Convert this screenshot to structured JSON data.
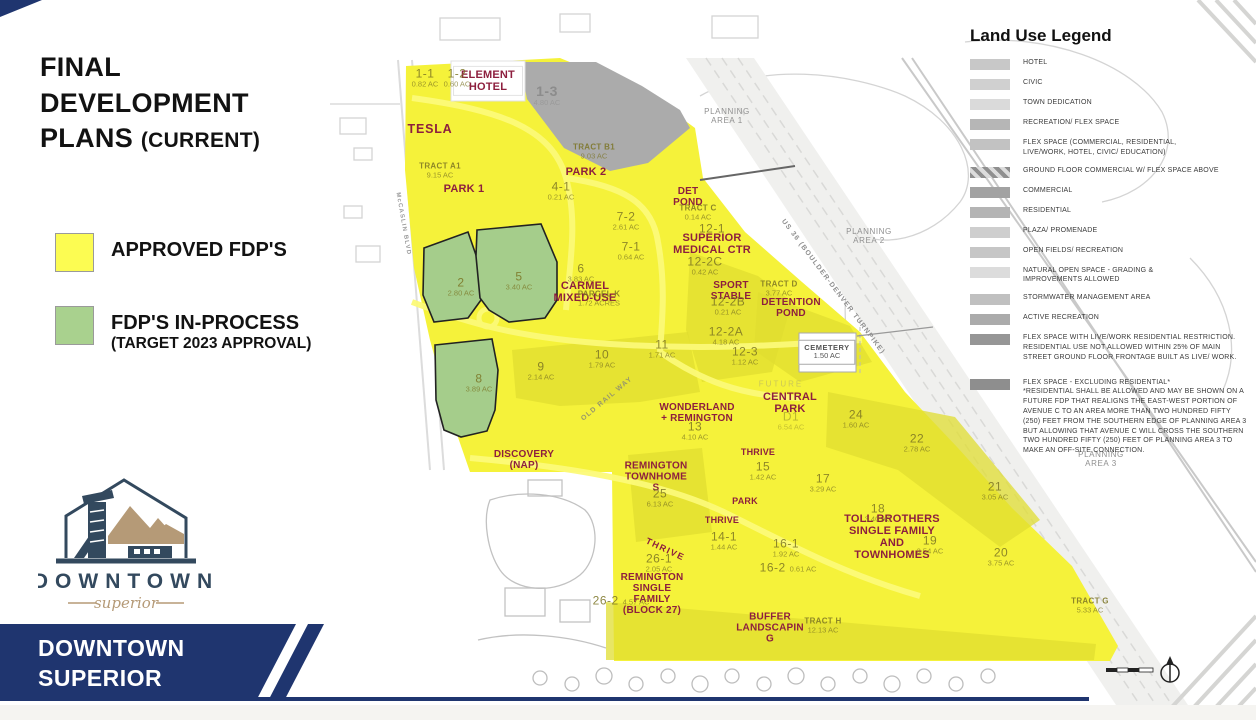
{
  "slide": {
    "title_line1": "FINAL",
    "title_line2": "DEVELOPMENT",
    "title_line3": "PLANS",
    "title_line3_suffix": "(CURRENT)",
    "fdp_legend": [
      {
        "label": "APPROVED FDP'S",
        "color": "#fcfc52"
      },
      {
        "label": "FDP'S IN-PROCESS",
        "sublabel": "(TARGET 2023 APPROVAL)",
        "color": "#a9d18e"
      }
    ],
    "logo": {
      "wordmark": "DOWNTOWN",
      "script": "superior"
    },
    "banner": {
      "line1": "DOWNTOWN",
      "line2": "SUPERIOR"
    },
    "colors": {
      "banner_navy": "#1f356f",
      "approved_yellow": "#f5f23a",
      "inprocess_green": "#a5cd8b",
      "label_red": "#8d1f3e"
    }
  },
  "land_use_legend": {
    "title": "Land Use Legend",
    "items": [
      {
        "label": "HOTEL",
        "color": "#c8c8c8"
      },
      {
        "label": "CIVIC",
        "color": "#d0d0d0"
      },
      {
        "label": "TOWN DEDICATION",
        "color": "#dadada"
      },
      {
        "label": "RECREATION/ FLEX SPACE",
        "color": "#b6b6b6"
      },
      {
        "label": "FLEX SPACE (COMMERCIAL, RESIDENTIAL,\nLIVE/WORK, HOTEL, CIVIC/ EDUCATION)",
        "color": "#c2c2c2"
      },
      {
        "label": "GROUND FLOOR COMMERCIAL W/ FLEX SPACE ABOVE",
        "color": "#c9c9c9"
      },
      {
        "label": "COMMERCIAL",
        "color": "#a2a2a2"
      },
      {
        "label": "RESIDENTIAL",
        "color": "#b4b4b4"
      },
      {
        "label": "PLAZA/ PROMENADE",
        "color": "#cecece"
      },
      {
        "label": "OPEN FIELDS/ RECREATION",
        "color": "#c6c6c6"
      },
      {
        "label": "NATURAL OPEN SPACE - GRADING &\nIMPROVEMENTS ALLOWED",
        "color": "#dcdcdc"
      },
      {
        "label": "STORMWATER MANAGEMENT AREA",
        "color": "#c0c0c0"
      },
      {
        "label": "ACTIVE RECREATION",
        "color": "#ababab"
      },
      {
        "label": "FLEX SPACE WITH LIVE/WORK RESIDENTIAL RESTRICTION. RESIDENTIAL USE NOT ALLOWED WITHIN 25% OF MAIN STREET GROUND FLOOR FRONTAGE BUILT AS LIVE/ WORK.",
        "color": "#969696"
      },
      {
        "label": "FLEX SPACE - EXCLUDING RESIDENTIAL*\n*RESIDENTIAL SHALL BE ALLOWED AND MAY BE SHOWN ON A FUTURE FDP THAT REALIGNS THE EAST-WEST PORTION OF AVENUE C TO AN AREA MORE THAN TWO HUNDRED FIFTY (250) FEET FROM THE SOUTHERN EDGE OF PLANNING AREA 3 BUT ALLOWING THAT AVENUE C WILL CROSS THE SOUTHERN TWO HUNDRED FIFTY (250) FEET OF PLANNING AREA 3 TO MAKE AN OFF-SITE CONNECTION.",
        "color": "#8e8e8e"
      }
    ]
  },
  "map": {
    "names": [
      {
        "t": "ELEMENT\nHOTEL"
      },
      {
        "t": "TESLA"
      },
      {
        "t": "PARK 1"
      },
      {
        "t": "PARK 2"
      },
      {
        "t": "DET\nPOND"
      },
      {
        "t": "SUPERIOR\nMEDICAL CTR"
      },
      {
        "t": "SPORT\nSTABLE"
      },
      {
        "t": "DETENTION\nPOND"
      },
      {
        "t": "CARMEL\nMIXED-USE"
      },
      {
        "t": "WONDERLAND\n+ REMINGTON"
      },
      {
        "t": "CENTRAL\nPARK"
      },
      {
        "t": "DISCOVERY\n(NAP)"
      },
      {
        "t": "REMINGTON\nTOWNHOME\nS"
      },
      {
        "t": "THRIVE"
      },
      {
        "t": "PARK"
      },
      {
        "t": "THRIVE"
      },
      {
        "t": "TOLL BROTHERS\nSINGLE FAMILY\nAND\nTOWNHOMES"
      },
      {
        "t": "THRIVE"
      },
      {
        "t": "REMINGTON\nSINGLE\nFAMILY\n(BLOCK 27)"
      },
      {
        "t": "BUFFER\nLANDSCAPIN\nG"
      }
    ],
    "parcels": [
      {
        "id": "1-1",
        "ac": "0.82 AC"
      },
      {
        "id": "1-2",
        "ac": "0.60 AC"
      },
      {
        "id": "1-3",
        "ac": "4.80 AC"
      },
      {
        "id": "TRACT A1",
        "ac": "9.15 AC"
      },
      {
        "id": "TRACT B1",
        "ac": "9.03 AC"
      },
      {
        "id": "4-1",
        "ac": "0.21 AC"
      },
      {
        "id": "7-2",
        "ac": "2.61 AC"
      },
      {
        "id": "7-1",
        "ac": "0.64 AC"
      },
      {
        "id": "TRACT C",
        "ac": "0.14 AC"
      },
      {
        "id": "12-1",
        "ac": ""
      },
      {
        "id": "12-2C",
        "ac": "0.42 AC"
      },
      {
        "id": "12-2B",
        "ac": "0.21 AC"
      },
      {
        "id": "TRACT D",
        "ac": "3.77 AC"
      },
      {
        "id": "12-2A",
        "ac": "4.18 AC"
      },
      {
        "id": "12-3",
        "ac": "1.12 AC"
      },
      {
        "id": "2",
        "ac": "2.80 AC"
      },
      {
        "id": "5",
        "ac": "3.40 AC"
      },
      {
        "id": "6",
        "ac": "3.83 AC"
      },
      {
        "id": "PARCEL K",
        "ac": "1.72 ACRES"
      },
      {
        "id": "8",
        "ac": "3.89 AC"
      },
      {
        "id": "9",
        "ac": "2.14 AC"
      },
      {
        "id": "10",
        "ac": "1.79 AC"
      },
      {
        "id": "11",
        "ac": "1.71 AC"
      },
      {
        "id": "13",
        "ac": "4.10 AC"
      },
      {
        "id": "D1",
        "ac": "6.54 AC"
      },
      {
        "id": "24",
        "ac": "1.60 AC"
      },
      {
        "id": "22",
        "ac": "2.78 AC"
      },
      {
        "id": "15",
        "ac": "1.42 AC"
      },
      {
        "id": "25",
        "ac": "6.13 AC"
      },
      {
        "id": "17",
        "ac": "3.29 AC"
      },
      {
        "id": "18",
        "ac": "3.40 AC"
      },
      {
        "id": "19",
        "ac": "3.54 AC"
      },
      {
        "id": "21",
        "ac": "3.05 AC"
      },
      {
        "id": "20",
        "ac": "3.75 AC"
      },
      {
        "id": "14-1",
        "ac": "1.44 AC"
      },
      {
        "id": "16-1",
        "ac": "1.92 AC"
      },
      {
        "id": "16-2",
        "ac": "0.61 AC"
      },
      {
        "id": "26-1",
        "ac": "2.05 AC"
      },
      {
        "id": "26-2",
        "ac": "4.57 AC"
      },
      {
        "id": "TRACT H",
        "ac": "12.13 AC"
      },
      {
        "id": "TRACT G",
        "ac": "5.33 AC"
      },
      {
        "id": "CEMETERY",
        "ac": "1.50 AC"
      }
    ],
    "streets": [
      {
        "t": "McCASLIN BLVD"
      },
      {
        "t": "US 36 (BOULDER-DENVER TURNPIKE)"
      },
      {
        "t": "OLD RAIL WAY"
      }
    ],
    "areas": [
      {
        "t": "PLANNING\nAREA 1"
      },
      {
        "t": "PLANNING\nAREA 2"
      },
      {
        "t": "PLANNING\nAREA 3"
      },
      {
        "t": "FUTURE"
      }
    ]
  }
}
